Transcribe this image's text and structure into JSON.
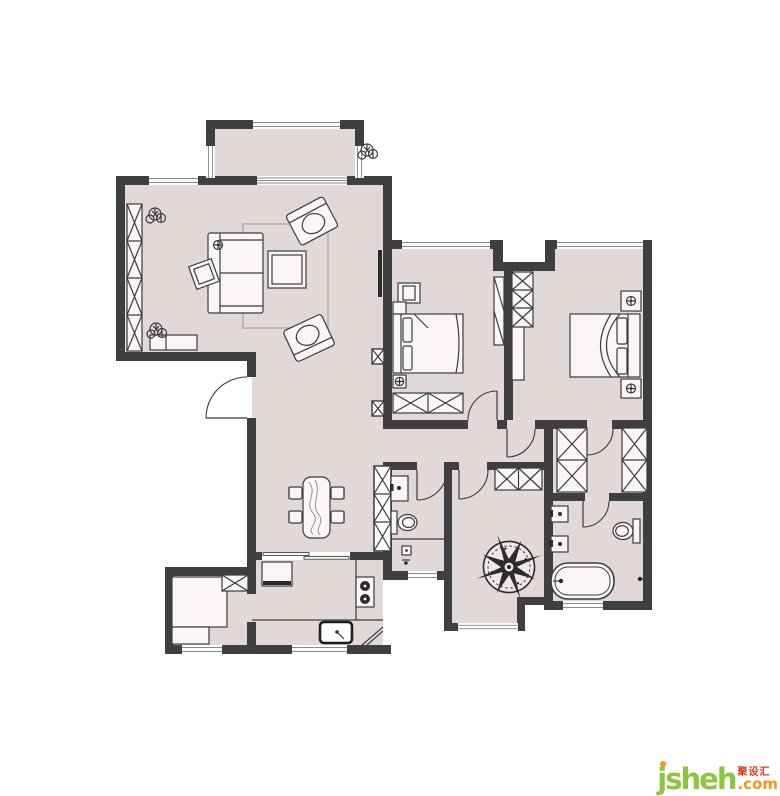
{
  "watermark": {
    "brand": "jsheh",
    "chinese": "聚设汇",
    "tld": ".com"
  },
  "palette": {
    "background": "#ffffff",
    "wall": "#3f3f42",
    "floor": "#e3d8d8",
    "outline": "#3b3b3d",
    "window_line": "#8a8a8a",
    "fixture_dark": "#2b2b2d",
    "logo_green": "#8cc63e",
    "logo_orange": "#f7941e",
    "logo_red": "#e8331c"
  },
  "plan": {
    "type": "residential-floor-plan",
    "rooms": [
      {
        "name": "balcony-north"
      },
      {
        "name": "living-room"
      },
      {
        "name": "dining-area"
      },
      {
        "name": "kitchen"
      },
      {
        "name": "utility-room"
      },
      {
        "name": "second-bedroom"
      },
      {
        "name": "master-bedroom"
      },
      {
        "name": "hallway"
      },
      {
        "name": "guest-bathroom"
      },
      {
        "name": "study-room"
      },
      {
        "name": "walk-in-closet"
      },
      {
        "name": "master-bathroom"
      },
      {
        "name": "balcony-south"
      }
    ],
    "furniture": [
      "sofa",
      "armchair",
      "coffee-table",
      "side-table",
      "floor-lamp",
      "tv",
      "tv-cabinet",
      "bench",
      "plant",
      "dining-table",
      "dining-chair",
      "fridge",
      "gas-stove",
      "kitchen-sink",
      "counter",
      "bed",
      "pillow",
      "nightstand",
      "ceiling-lamp",
      "wardrobe",
      "dresser",
      "toilet",
      "wash-basin",
      "bathtub",
      "floor-drain",
      "water-tap",
      "compass-rose",
      "entry-door",
      "interior-door",
      "sliding-door",
      "window",
      "structural-column",
      "duct-shaft"
    ]
  }
}
